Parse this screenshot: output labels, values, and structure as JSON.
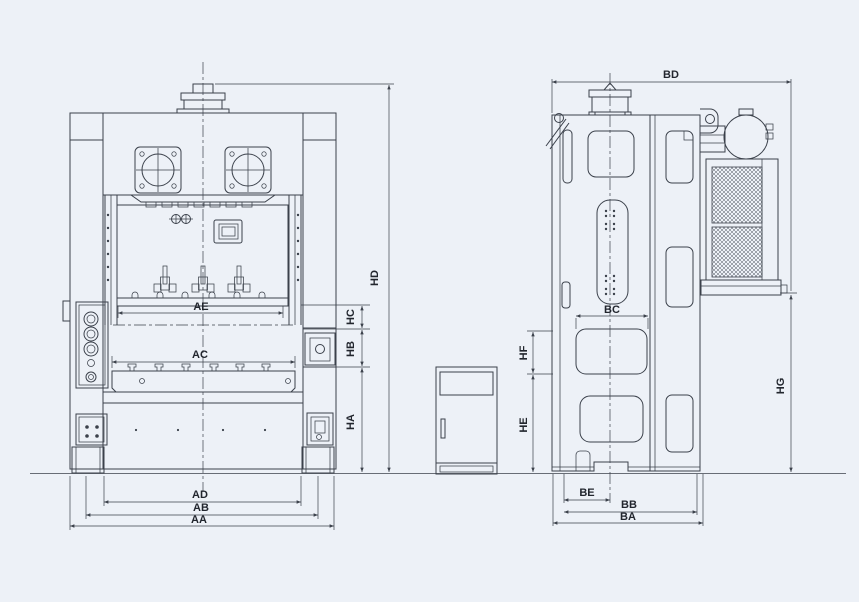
{
  "colors": {
    "background": "#edf1f7",
    "line": "#3b414b",
    "label": "#22262e"
  },
  "dims": {
    "AA": "AA",
    "AB": "AB",
    "AC": "AC",
    "AD": "AD",
    "AE": "AE",
    "HA": "HA",
    "HB": "HB",
    "HC": "HC",
    "HD": "HD",
    "BA": "BA",
    "BB": "BB",
    "BC": "BC",
    "BD": "BD",
    "BE": "BE",
    "HE": "HE",
    "HF": "HF",
    "HG": "HG"
  }
}
